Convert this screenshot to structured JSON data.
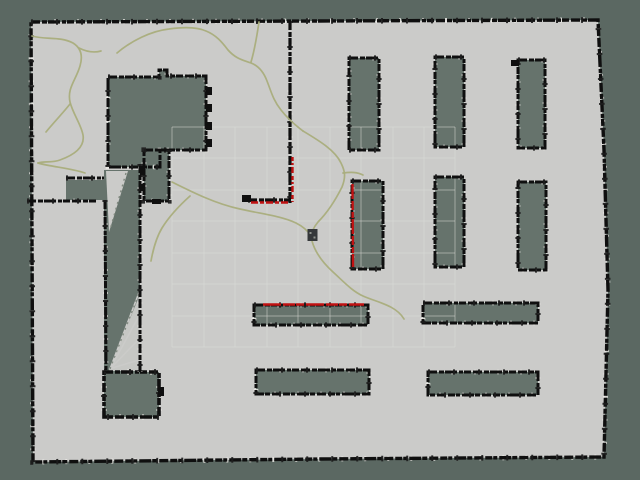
{
  "scene": {
    "canvas": {
      "width": 640,
      "height": 480
    },
    "colors": {
      "background": "#5b6862",
      "free_space": "#cbcbc9",
      "unknown": "#66736c",
      "wall": "#0f0f0f",
      "wall_blob": "#1c1c1c",
      "white_noise": "#eceae6",
      "grid_line": "#dcddd9",
      "trajectory": "#a9ad7c",
      "laser_scan": "#c01212",
      "robot": "#35383a",
      "robot_dot": "#90948f",
      "ray_dot": "#80897f"
    },
    "dashes": {
      "main": "9 2 5 1 12 2 4 1 7 2",
      "blob": "2 23",
      "white": "2 21"
    },
    "map_outline": [
      [
        31,
        22
      ],
      [
        598,
        20
      ],
      [
        604,
        150
      ],
      [
        608,
        290
      ],
      [
        604,
        457
      ],
      [
        320,
        459
      ],
      [
        33,
        462
      ]
    ],
    "grid": {
      "x_lines": [
        172,
        204,
        235,
        267,
        298,
        330,
        361,
        393,
        424,
        455
      ],
      "y_lines": [
        127,
        158,
        190,
        221,
        253,
        284,
        316,
        347
      ],
      "x_min": 172,
      "x_max": 455,
      "y_min": 127,
      "y_max": 347
    },
    "unknown_regions": [
      {
        "name": "inner-structure-main",
        "border": true,
        "wall_width": 3,
        "points": [
          [
            108,
            77
          ],
          [
            159,
            77
          ],
          [
            159,
            70
          ],
          [
            167,
            70
          ],
          [
            167,
            76
          ],
          [
            206,
            76
          ],
          [
            206,
            150
          ],
          [
            160,
            150
          ],
          [
            160,
            167
          ],
          [
            108,
            167
          ]
        ]
      },
      {
        "name": "inner-structure-annex",
        "border": true,
        "wall_width": 3,
        "points": [
          [
            144,
            150
          ],
          [
            169,
            150
          ],
          [
            169,
            201
          ],
          [
            144,
            201
          ]
        ]
      },
      {
        "name": "left-dark-band",
        "border": false,
        "points": [
          [
            66,
            180
          ],
          [
            105,
            180
          ],
          [
            105,
            200
          ],
          [
            66,
            200
          ]
        ]
      },
      {
        "name": "corridor-shadow",
        "border": false,
        "points": [
          [
            104,
            170
          ],
          [
            140,
            170
          ],
          [
            140,
            372
          ],
          [
            104,
            372
          ]
        ]
      },
      {
        "name": "corridor-block",
        "border": true,
        "wall_width": 3.6,
        "points": [
          [
            104,
            372
          ],
          [
            159,
            372
          ],
          [
            159,
            417
          ],
          [
            104,
            417
          ]
        ]
      },
      {
        "name": "shelf-v1",
        "border": true,
        "wall_width": 3,
        "points": [
          [
            349,
            58
          ],
          [
            379,
            58
          ],
          [
            379,
            150
          ],
          [
            349,
            150
          ]
        ]
      },
      {
        "name": "shelf-v2",
        "border": true,
        "wall_width": 3,
        "points": [
          [
            435,
            57
          ],
          [
            464,
            57
          ],
          [
            464,
            147
          ],
          [
            435,
            147
          ]
        ]
      },
      {
        "name": "shelf-v3",
        "border": true,
        "wall_width": 3,
        "points": [
          [
            518,
            60
          ],
          [
            545,
            60
          ],
          [
            545,
            148
          ],
          [
            518,
            148
          ]
        ]
      },
      {
        "name": "shelf-v4",
        "border": true,
        "wall_width": 3,
        "points": [
          [
            352,
            181
          ],
          [
            383,
            181
          ],
          [
            383,
            269
          ],
          [
            352,
            269
          ]
        ]
      },
      {
        "name": "shelf-v5",
        "border": true,
        "wall_width": 3,
        "points": [
          [
            435,
            177
          ],
          [
            464,
            177
          ],
          [
            464,
            267
          ],
          [
            435,
            267
          ]
        ]
      },
      {
        "name": "shelf-v6",
        "border": true,
        "wall_width": 3,
        "points": [
          [
            518,
            182
          ],
          [
            546,
            182
          ],
          [
            546,
            270
          ],
          [
            518,
            270
          ]
        ]
      },
      {
        "name": "shelf-h1",
        "border": true,
        "wall_width": 3,
        "points": [
          [
            254,
            305
          ],
          [
            368,
            305
          ],
          [
            368,
            325
          ],
          [
            254,
            325
          ]
        ]
      },
      {
        "name": "shelf-h2",
        "border": true,
        "wall_width": 3,
        "points": [
          [
            423,
            303
          ],
          [
            538,
            303
          ],
          [
            538,
            323
          ],
          [
            423,
            323
          ]
        ]
      },
      {
        "name": "shelf-h3",
        "border": true,
        "wall_width": 3,
        "points": [
          [
            256,
            370
          ],
          [
            369,
            370
          ],
          [
            369,
            394
          ],
          [
            256,
            394
          ]
        ]
      },
      {
        "name": "shelf-h4",
        "border": true,
        "wall_width": 3,
        "points": [
          [
            428,
            372
          ],
          [
            538,
            372
          ],
          [
            538,
            395
          ],
          [
            428,
            395
          ]
        ]
      }
    ],
    "walls": [
      {
        "name": "divider-vertical",
        "width": 3.2,
        "points": [
          [
            290,
            21
          ],
          [
            290,
            203
          ]
        ]
      },
      {
        "name": "divider-foot",
        "width": 3.2,
        "points": [
          [
            248,
            200
          ],
          [
            292,
            200
          ]
        ]
      },
      {
        "name": "band-top-wall",
        "width": 3,
        "points": [
          [
            66,
            178
          ],
          [
            104,
            178
          ]
        ]
      },
      {
        "name": "lower-room-top-wall",
        "width": 3,
        "points": [
          [
            27,
            201
          ],
          [
            96,
            201
          ]
        ]
      },
      {
        "name": "corridor-left-wall",
        "width": 3,
        "points": [
          [
            105,
            200
          ],
          [
            106,
            372
          ]
        ]
      },
      {
        "name": "corridor-right-wall",
        "width": 3,
        "points": [
          [
            140,
            164
          ],
          [
            140,
            372
          ]
        ]
      }
    ],
    "notches": [
      {
        "name": "notch-house-1",
        "x": 206,
        "y": 87,
        "w": 6,
        "h": 8
      },
      {
        "name": "notch-house-2",
        "x": 206,
        "y": 104,
        "w": 6,
        "h": 8
      },
      {
        "name": "notch-house-3",
        "x": 206,
        "y": 122,
        "w": 6,
        "h": 8
      },
      {
        "name": "notch-house-4",
        "x": 206,
        "y": 139,
        "w": 6,
        "h": 8
      },
      {
        "name": "notch-annex-1",
        "x": 140,
        "y": 168,
        "w": 5,
        "h": 7
      },
      {
        "name": "notch-annex-2",
        "x": 140,
        "y": 184,
        "w": 5,
        "h": 7
      },
      {
        "name": "notch-annex-3",
        "x": 152,
        "y": 199,
        "w": 9,
        "h": 5
      },
      {
        "name": "notch-divider-foot-end",
        "x": 242,
        "y": 195,
        "w": 9,
        "h": 7
      },
      {
        "name": "notch-shelf-v3",
        "x": 511,
        "y": 60,
        "w": 8,
        "h": 6
      },
      {
        "name": "notch-block",
        "x": 158,
        "y": 387,
        "w": 6,
        "h": 9
      }
    ],
    "light_overlays": {
      "funnel_triangle": [
        [
          106,
          171
        ],
        [
          128,
          171
        ],
        [
          109,
          232
        ]
      ],
      "funnel_dotted_edge": [
        [
          126,
          173
        ],
        [
          110,
          230
        ]
      ],
      "fan_triangle": [
        [
          109,
          371
        ],
        [
          140,
          294
        ],
        [
          140,
          371
        ]
      ],
      "fan_rays": [
        [
          [
            110,
            369
          ],
          [
            140,
            290
          ]
        ],
        [
          [
            110,
            369
          ],
          [
            140,
            314
          ]
        ],
        [
          [
            110,
            369
          ],
          [
            140,
            338
          ]
        ],
        [
          [
            109,
            369
          ],
          [
            139,
            360
          ]
        ]
      ],
      "fan_dotted_edge": [
        [
          110,
          369
        ],
        [
          139,
          293
        ]
      ]
    },
    "trajectories": [
      {
        "name": "trajectory-left-room",
        "d": "M 32 36 C 45 40 60 36 73 43 C 81 48 83 56 80 66 C 76 80 67 88 70 102 C 73 114 81 124 83 135 C 85 147 74 155 60 160 C 52 163 44 161 38 163"
      },
      {
        "name": "trajectory-left-twig-1",
        "d": "M 79 48 C 87 52 94 53 101 51"
      },
      {
        "name": "trajectory-left-twig-2",
        "d": "M 70 104 C 63 113 54 122 46 132"
      },
      {
        "name": "trajectory-left-tail",
        "d": "M 38 163 C 52 167 70 168 85 173"
      },
      {
        "name": "trajectory-top-arc",
        "d": "M 117 53 C 131 41 151 31 169 29 C 183 27 197 27 206 31 C 216 35 222 42 228 50 C 236 59 243 60 251 63 C 259 66 264 73 267 81 C 271 91 273 100 281 110 C 288 119 295 125 303 131"
      },
      {
        "name": "trajectory-top-twig",
        "d": "M 259 22 C 257 35 255 49 251 62"
      },
      {
        "name": "trajectory-main",
        "d": "M 303 131 C 318 140 335 150 341 163 C 345 171 346 177 342 187 C 336 199 329 211 318 222 C 313 228 310 234 312 241 C 315 252 322 262 333 272 C 344 282 352 291 363 296 C 376 302 396 305 404 319"
      },
      {
        "name": "trajectory-main-stub",
        "d": "M 343 173 C 351 172 357 172 363 175"
      },
      {
        "name": "trajectory-center-diagonal",
        "d": "M 172 182 C 192 192 216 204 240 209 C 262 214 281 216 296 223 C 304 227 308 231 311 236"
      },
      {
        "name": "trajectory-center-branch",
        "d": "M 190 196 C 180 205 170 215 162 228 C 156 238 153 250 151 261"
      }
    ],
    "laser_scans": [
      {
        "name": "scan-divider-vertical",
        "x1": 292.5,
        "y1": 157,
        "x2": 292.5,
        "y2": 202,
        "dash": "4 2 2 2 6 3"
      },
      {
        "name": "scan-divider-foot",
        "x1": 251,
        "y1": 202.5,
        "x2": 290,
        "y2": 202.5,
        "dash": "7 2 4 2"
      },
      {
        "name": "scan-shelf-v4-left",
        "x1": 352.5,
        "y1": 184,
        "x2": 353,
        "y2": 267,
        "dash": "15 2 9 2 6 1"
      },
      {
        "name": "scan-shelf-h1-top",
        "x1": 263,
        "y1": 304.5,
        "x2": 364,
        "y2": 304.5,
        "dash": "18 2 12 1 8 2"
      }
    ],
    "robot": {
      "x": 307.5,
      "y": 229,
      "width": 10,
      "height": 12,
      "dots": [
        [
          309.5,
          232
        ],
        [
          313.5,
          236.5
        ]
      ],
      "dot_size": 2
    }
  }
}
